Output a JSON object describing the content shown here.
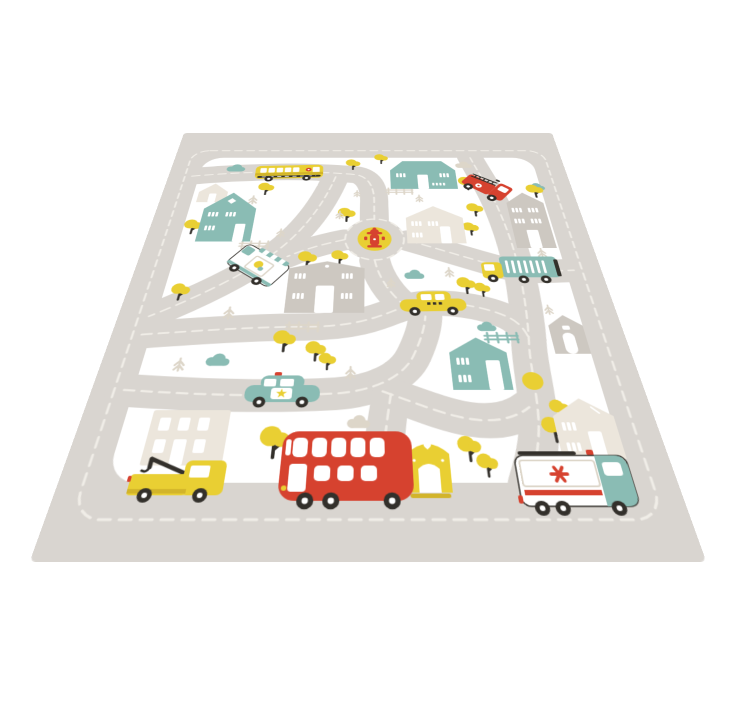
{
  "scene": {
    "type": "product-photo",
    "subject": "kids city road play rug shown at a perspective angle on a plain white backdrop"
  },
  "colors": {
    "background": "#ffffff",
    "rug_gray": "#d9d5d0",
    "island_white": "#ffffff",
    "road_marking": "#f0ede7",
    "teal": "#8abcb4",
    "teal_deep": "#6fa79e",
    "yellow": "#e9cf33",
    "yellow_deep": "#d2b42a",
    "red": "#d6422f",
    "beige": "#ddd6c9",
    "beige_house": "#ece6dc",
    "gray_house": "#cdc8c1",
    "dark": "#33302b"
  },
  "rug": {
    "design": "top-down illustrated town map: gray roads with cream dashed markings, white blocks with houses, trees and vehicles",
    "vehicles": [
      {
        "name": "school-bus",
        "color": "yellow",
        "location": "top-left road"
      },
      {
        "name": "fire-truck",
        "color": "red",
        "location": "top-right curve"
      },
      {
        "name": "ice-cream-van",
        "color": "white",
        "location": "left diagonal road"
      },
      {
        "name": "garbage-truck",
        "color": "teal with yellow cab",
        "location": "right road"
      },
      {
        "name": "taxi",
        "color": "yellow",
        "location": "center road"
      },
      {
        "name": "police-car",
        "color": "teal",
        "location": "lower-left road"
      },
      {
        "name": "tow-truck",
        "color": "yellow",
        "location": "bottom road left"
      },
      {
        "name": "double-decker-bus",
        "color": "red",
        "location": "bottom road center"
      },
      {
        "name": "ambulance",
        "color": "white and teal",
        "location": "bottom road right"
      }
    ],
    "landmarks": [
      {
        "name": "fire-hydrant-roundabout",
        "detail": "red hydrant on yellow circle"
      },
      {
        "name": "yellow-dot-junction",
        "detail": "plain yellow circle on right road"
      }
    ],
    "buildings": {
      "teal_houses": 3,
      "beige_cottages": 3,
      "gray_houses": 3,
      "apartment_building": 1,
      "yellow_dog_house": 1
    },
    "nature": {
      "yellow_trees": 22,
      "pine_trees": 13,
      "teal_clouds": 5,
      "beige_clouds": 3,
      "fences": 3
    }
  }
}
